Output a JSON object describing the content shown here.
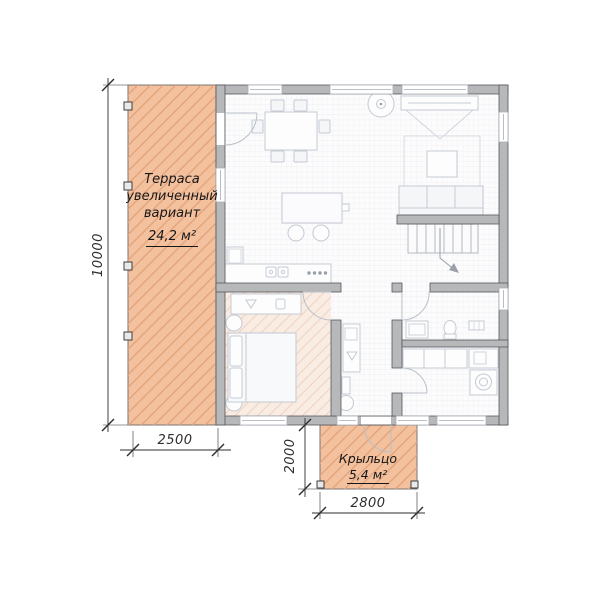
{
  "labels": {
    "terrace": {
      "line1": "Терраса",
      "line2": "увеличенный",
      "line3": "вариант",
      "area": "24,2 м²"
    },
    "porch": {
      "name": "Крыльцо",
      "area": "5,4 м²"
    }
  },
  "dimensions": {
    "height_total": "10000",
    "terrace_width": "2500",
    "porch_depth": "2000",
    "porch_width": "2800"
  },
  "colors": {
    "terrace_fill": "#f3c19e",
    "terrace_hatch": "#e2a179",
    "bedroom_fill": "#f9ece3",
    "bedroom_hatch": "#efd3c2",
    "wall_fill": "#b7b8ba",
    "wall_edge": "#56575b",
    "floor": "#fcfcfd",
    "floor_grid": "#ececf1",
    "furniture_line": "#c5cad3",
    "dim_line": "#2e2e2e",
    "text": "#161616"
  },
  "plan_items": [
    "terrace",
    "porch",
    "dining-table",
    "chairs",
    "ceiling-fan",
    "tv",
    "rug",
    "coffee-table",
    "sofa",
    "staircase",
    "kitchen-island",
    "bar-stools",
    "fridge",
    "kitchen-sink",
    "cooktop",
    "bed",
    "vanity",
    "hall-cabinet",
    "washbasin",
    "toilet",
    "laundry-counter",
    "washing-machine",
    "doors",
    "windows",
    "terrace-posts",
    "porch-posts"
  ]
}
